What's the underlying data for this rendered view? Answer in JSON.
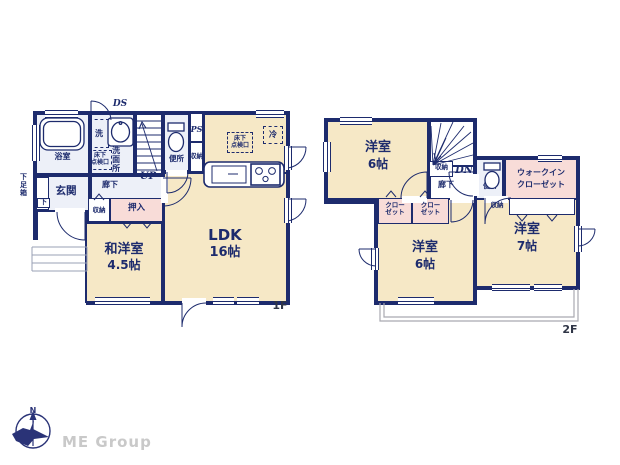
{
  "plan": {
    "floor1": {
      "floor_label": "1F",
      "bath": "浴室",
      "washer": "洗",
      "washroom": "洗面所",
      "hatch_top_l1": "床下",
      "hatch_top_l2": "点検口",
      "ds": "DS",
      "ps": "PS",
      "up": "UP",
      "toilet": "便所",
      "storage_small": "収納",
      "entrance": "玄関",
      "shoe_cabinet": "下足箱",
      "shoe_cabinet_mark": "下",
      "hallway": "廊下",
      "storage_hall": "収納",
      "futon_closet": "押入",
      "room_name": "和洋室",
      "room_size": "4.5帖",
      "ldk_name": "LDK",
      "ldk_size": "16帖",
      "fridge": "冷",
      "hatch_ldk_l1": "床下",
      "hatch_ldk_l2": "点検口"
    },
    "floor2": {
      "floor_label": "2F",
      "bedroom_a_name": "洋室",
      "bedroom_a_size": "6帖",
      "dn": "DN",
      "storage_stairs": "収納",
      "hallway": "廊下",
      "toilet": "便所",
      "wic_l1": "ウォークイン",
      "wic_l2": "クローゼット",
      "closet_l1": "クロー",
      "closet_l2": "ゼット",
      "storage_c": "収納",
      "bedroom_b_name": "洋室",
      "bedroom_b_size": "6帖",
      "bedroom_c_name": "洋室",
      "bedroom_c_size": "7帖"
    }
  },
  "footer": {
    "north": "N",
    "logo": "ME Group"
  },
  "colors": {
    "wall": "#1d2b6d",
    "room_cream": "#f6e8c6",
    "closet_pink": "#f8dcd8",
    "wet_lavender": "#edf0f8",
    "balcony_gray": "#a9a9b0",
    "logo_gray": "#c9c9c9"
  }
}
